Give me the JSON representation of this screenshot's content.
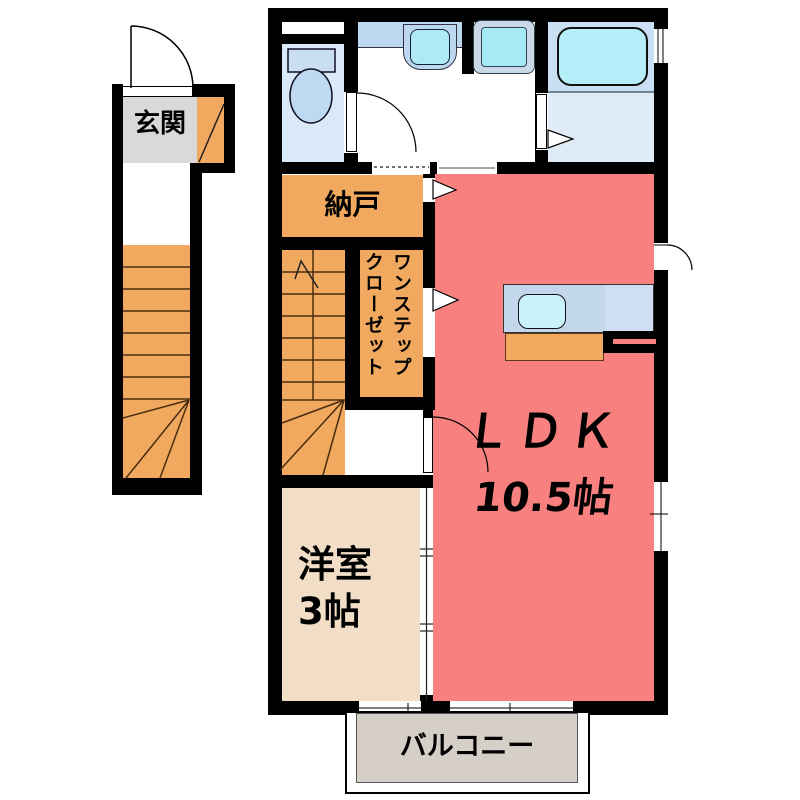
{
  "plan_title": "2F apartment floor plan",
  "rooms": {
    "entrance": {
      "label": "玄関"
    },
    "storage": {
      "label": "納戸"
    },
    "closet": {
      "label_col_right": "ワンステップ",
      "label_col_left": "クローゼット"
    },
    "ldk": {
      "label": "ＬＤＫ",
      "area": "10.5帖"
    },
    "western_room": {
      "label": "洋室",
      "area": "3帖"
    },
    "balcony": {
      "label": "バルコニー"
    }
  },
  "fixtures": [
    "toilet",
    "washbasin",
    "washing-machine",
    "bathtub",
    "kitchen-sink",
    "staircase-exterior",
    "staircase-interior"
  ],
  "colors": {
    "wall": "#000000",
    "ldk_floor": "#F8807E",
    "storage_closet_stairs": "#F0A95E",
    "western_room_floor": "#F2DEC6",
    "entrance_floor": "#D9D9D9",
    "balcony_floor": "#D6CFC7",
    "toilet_floor": "#D9E9F8",
    "bath_upper_floor": "#C8DFF4",
    "bath_lower_floor": "#DFECF8",
    "bathtub": "#B5EEF9",
    "vanity_counter": "#BCD8F0",
    "basin": "#AEE9F6",
    "washer_drum": "#A6EAF6",
    "kitchen_counter": "#C3D7EC",
    "kitchen_sink": "#C9F2FA"
  }
}
